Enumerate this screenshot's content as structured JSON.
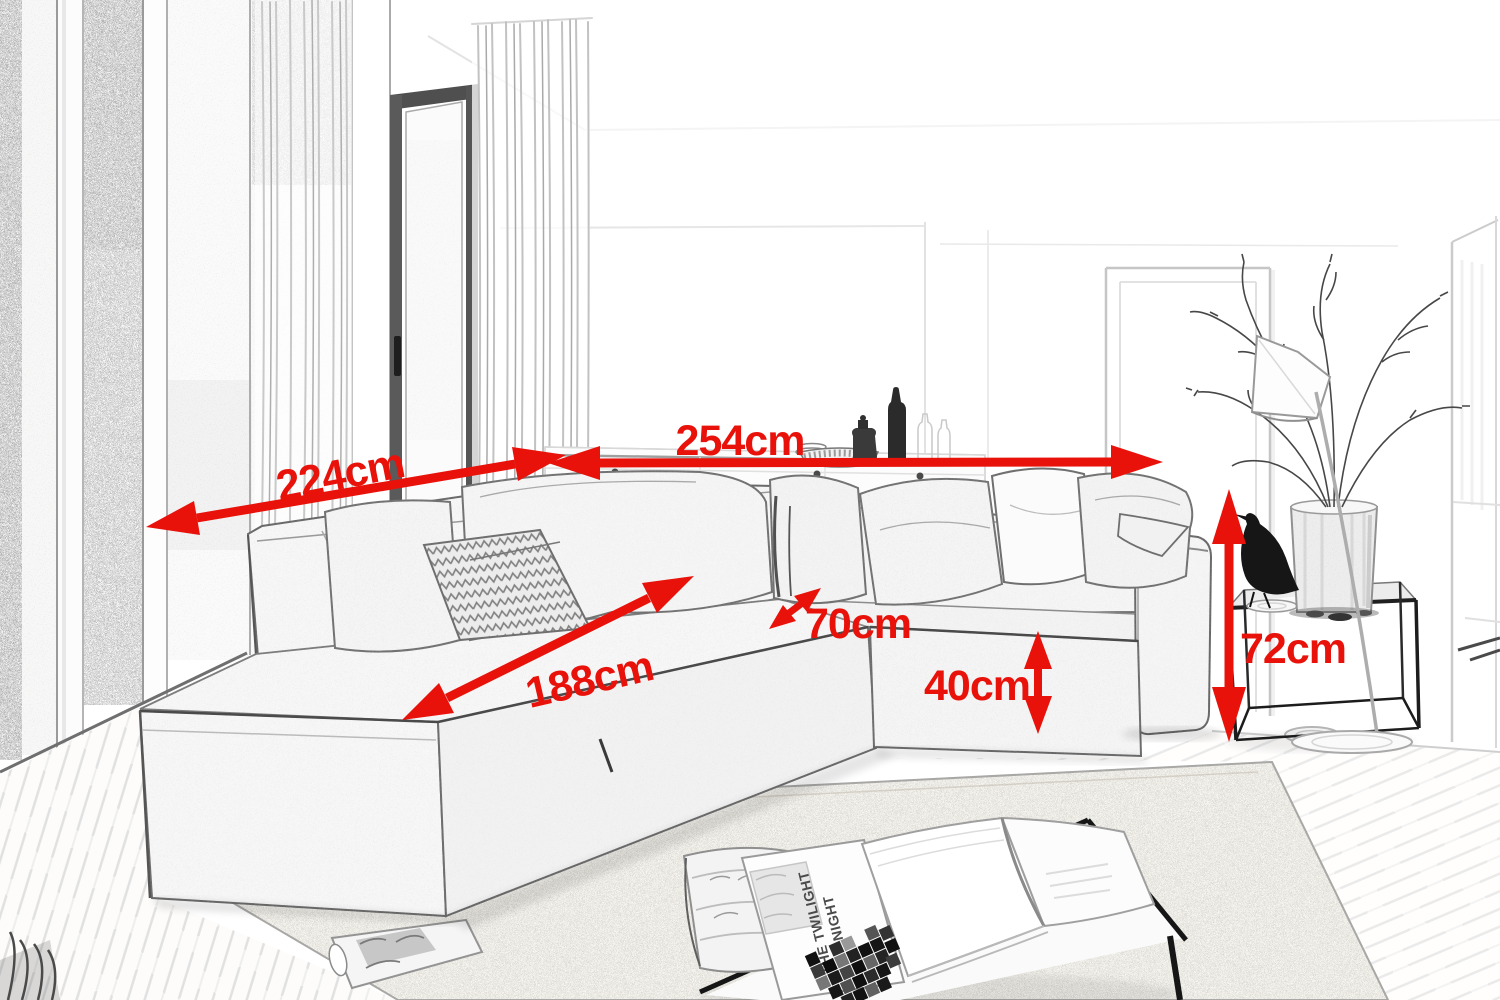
{
  "annotations": {
    "color": "#e8120b",
    "dimensions": [
      {
        "id": "back-width-left",
        "label": "224cm"
      },
      {
        "id": "back-width-right",
        "label": "254cm"
      },
      {
        "id": "chaise-length",
        "label": "188cm"
      },
      {
        "id": "seat-depth",
        "label": "70cm"
      },
      {
        "id": "seat-height",
        "label": "40cm"
      },
      {
        "id": "side-height",
        "label": "72cm"
      }
    ]
  },
  "decor": {
    "magazine_title_line1": "THE TWILIGHT",
    "magazine_title_line2": "NIGHT"
  }
}
